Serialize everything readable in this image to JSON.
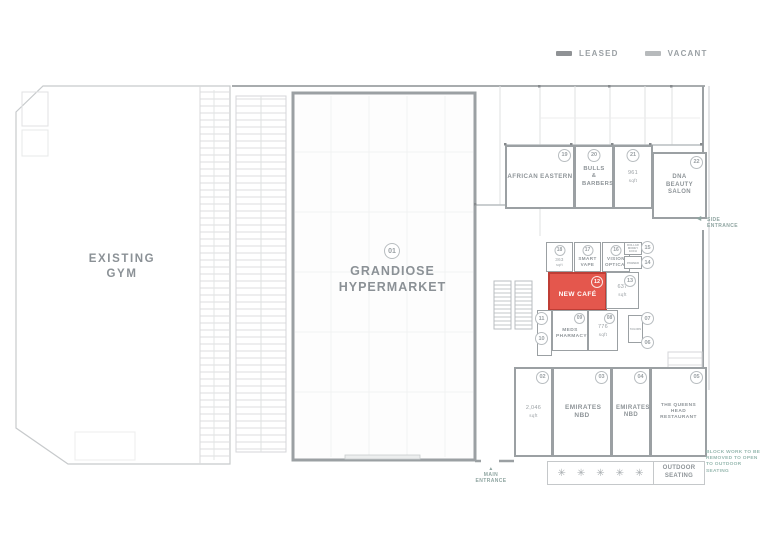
{
  "legend": {
    "leased_label": "LEASED",
    "vacant_label": "VACANT",
    "leased_color": "#8f9295",
    "vacant_color": "#b7babc"
  },
  "areas": {
    "gym": {
      "line1": "EXISTING",
      "line2": "GYM"
    },
    "hypermarket": {
      "number": "01",
      "line1": "GRANDIOSE",
      "line2": "HYPERMARKET"
    }
  },
  "units": [
    {
      "number": "19",
      "name": "AFRICAN EASTERN"
    },
    {
      "number": "20",
      "name": "BULLS & BARBERS"
    },
    {
      "number": "21",
      "area": "961",
      "area_unit": "sqft"
    },
    {
      "number": "22",
      "name": "DNA BEAUTY SALON"
    },
    {
      "number": "18",
      "area": "363",
      "area_unit": "sqft"
    },
    {
      "number": "17",
      "name": "SMART VAPE"
    },
    {
      "number": "16",
      "name": "VISION OPTICAL"
    },
    {
      "number": "15",
      "name": "DOLLAR MONEY EXCH"
    },
    {
      "number": "14",
      "name": "PAWNED"
    },
    {
      "number": "12",
      "name": "NEW CAFÉ",
      "status": "highlighted"
    },
    {
      "number": "13",
      "area": "637",
      "area_unit": "sqft"
    },
    {
      "number": "11"
    },
    {
      "number": "10"
    },
    {
      "number": "09",
      "name": "MEDS PHARMACY"
    },
    {
      "number": "08",
      "area": "776",
      "area_unit": "sqft"
    },
    {
      "number": "07"
    },
    {
      "number": "06"
    },
    {
      "name": "TAILORS"
    },
    {
      "number": "02",
      "area": "2,046",
      "area_unit": "sqft"
    },
    {
      "number": "03",
      "name": "EMIRATES NBD"
    },
    {
      "number": "04",
      "name": "EMIRATES NBD"
    },
    {
      "number": "05",
      "name": "THE QUEENS HEAD RESTAURANT"
    }
  ],
  "annotations": {
    "side_entrance": "SIDE ENTRANCE",
    "side_entrance_arrow": "◀",
    "main_entrance": "MAIN ENTRANCE",
    "main_entrance_arrow": "▲",
    "outdoor_seating": "OUTDOOR SEATING",
    "seat_symbol": "✳",
    "block_work_note": "BLOCK WORK TO BE REMOVED TO OPEN TO OUTDOOR SEATING"
  },
  "colors": {
    "highlight_fill": "#e4574d",
    "highlight_border": "#bf3d35",
    "wall": "#9ba0a3",
    "annotation_teal": "#96b8af"
  }
}
